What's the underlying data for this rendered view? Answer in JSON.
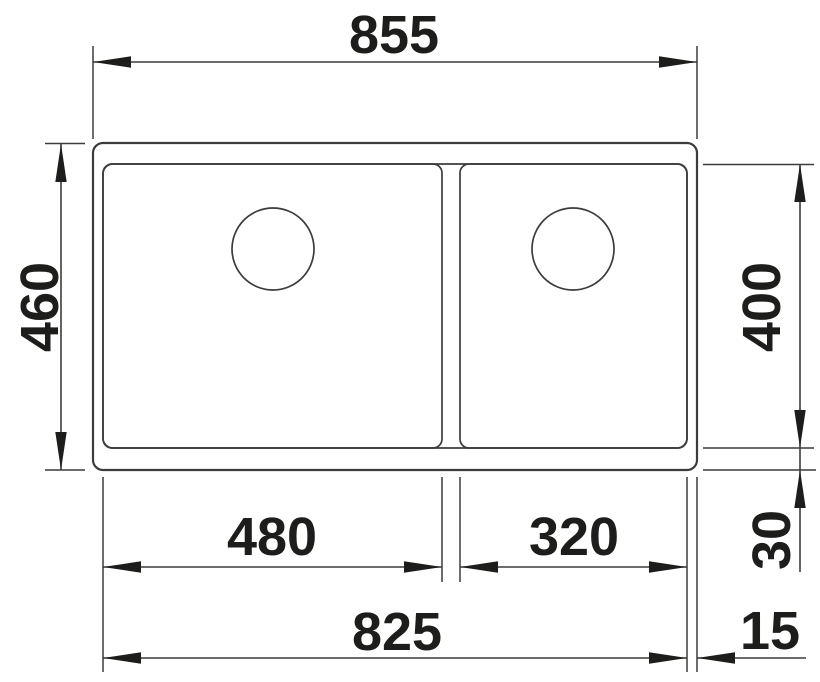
{
  "drawing": {
    "subject": "double-bowl undermount sink technical drawing, top view",
    "units": "mm",
    "colors": {
      "line": "#3c3c3a",
      "text": "#1d1d1b",
      "background": "#ffffff"
    },
    "dimensions": {
      "overall_width": "855",
      "overall_depth": "460",
      "bowl_depth": "400",
      "left_bowl_width": "480",
      "right_bowl_width": "320",
      "inner_total_width": "825",
      "rear_edge_offset": "30",
      "side_edge_offset": "15"
    }
  }
}
